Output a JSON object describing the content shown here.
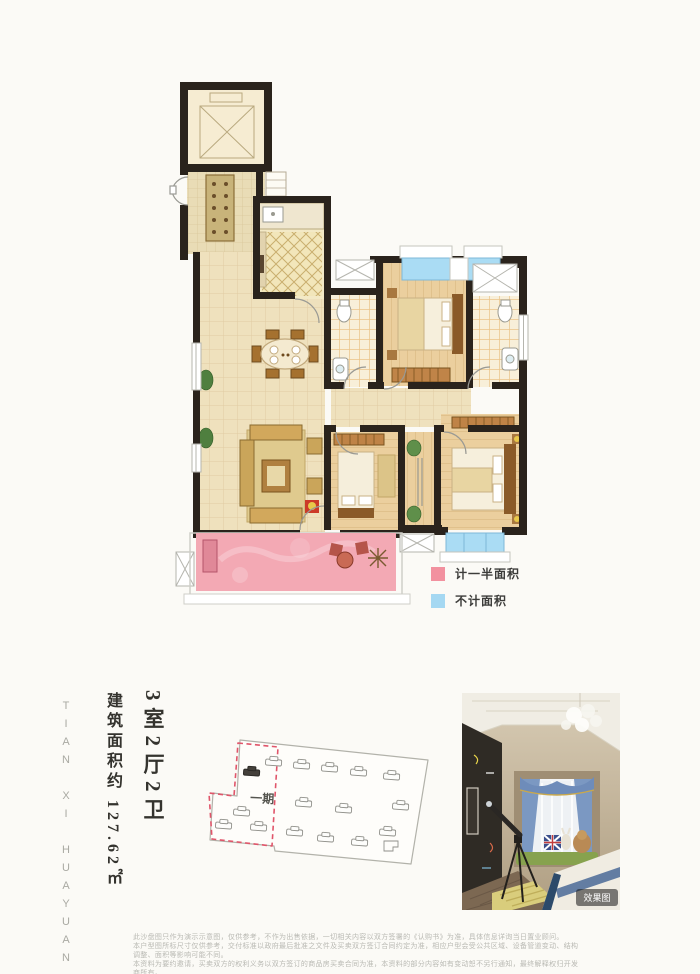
{
  "info": {
    "unit_type": "3室2厅2卫",
    "area_text": "建筑面积约 127.62㎡",
    "project_name_en": "TIAN XI HUAYUAN"
  },
  "floor_plan": {
    "legend": {
      "items": [
        {
          "label": "计一半面积",
          "color": "#f2919f"
        },
        {
          "label": "不计面积",
          "color": "#a5d8f2"
        }
      ]
    },
    "colors": {
      "wall": "#2a231c",
      "tile_floor": "#f0e3c2",
      "wood_floor": "#eace9b",
      "balcony_half_area_pink": "#f3a9b4",
      "window_not_counted_blue": "#aadcf4"
    }
  },
  "site_plan": {
    "phase_label": "一期"
  },
  "photo": {
    "watermark": "效果图"
  },
  "disclaimer": {
    "lines": [
      "此沙盘图只作为演示示意图，仅供参考，不作为出售依据，一切相关内容以双方签署的《认购书》为准，具体信息详询当日置业顾问。",
      "本户型图所标尺寸仅供参考，交付标准以政府最后批准之文件及买卖双方签订合同约定为准，相应户型会受公共区域、设备管道变动、结构调整、面积等影响可能不同。",
      "本资料为要约邀请，买卖双方的权利义务以双方签订的商品房买卖合同为准，本资料的部分内容如有变动恕不另行通知，最终解释权归开发商所有。"
    ]
  }
}
